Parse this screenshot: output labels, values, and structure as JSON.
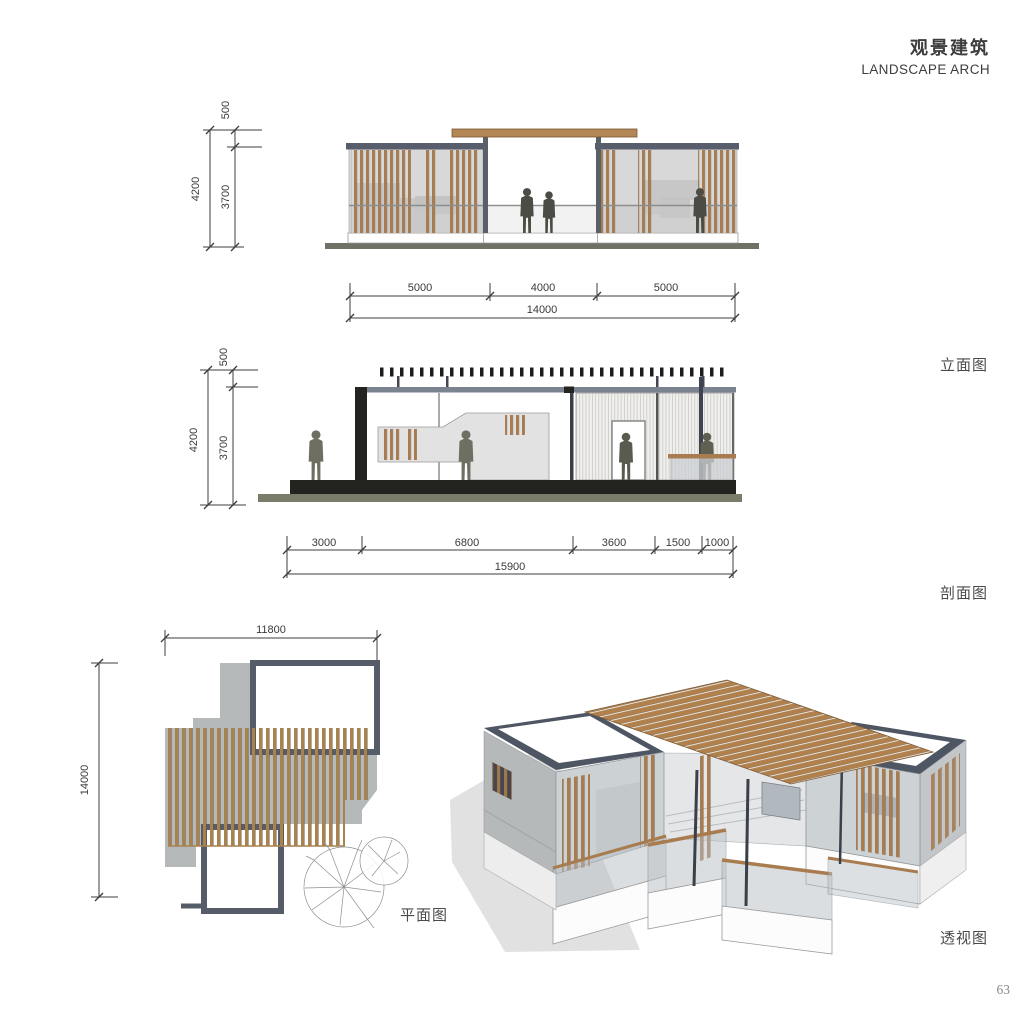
{
  "header": {
    "title_cn": "观景建筑",
    "title_en": "LANDSCAPE ARCH"
  },
  "page_number": "63",
  "drawings": {
    "elevation": {
      "label": "立面图",
      "dims": {
        "v_upper": "500",
        "v_total": "4200",
        "v_lower": "3700",
        "h_segments": [
          "5000",
          "4000",
          "5000"
        ],
        "h_total": "14000"
      }
    },
    "section": {
      "label": "剖面图",
      "dims": {
        "v_upper": "500",
        "v_total": "4200",
        "v_lower": "3700",
        "h_segments": [
          "3000",
          "6800",
          "3600",
          "1500",
          "1000"
        ],
        "h_total": "15900"
      }
    },
    "plan": {
      "label": "平面图",
      "dims": {
        "width": "11800",
        "height": "14000"
      }
    },
    "perspective": {
      "label": "透视图"
    }
  },
  "colors": {
    "wood": "#a87c4f",
    "roof_frame": "#4f5663",
    "ground": "#7a7c6a",
    "slab_black": "#23231f",
    "figure": "#5f6052",
    "dim_line": "#3c3c3c"
  }
}
